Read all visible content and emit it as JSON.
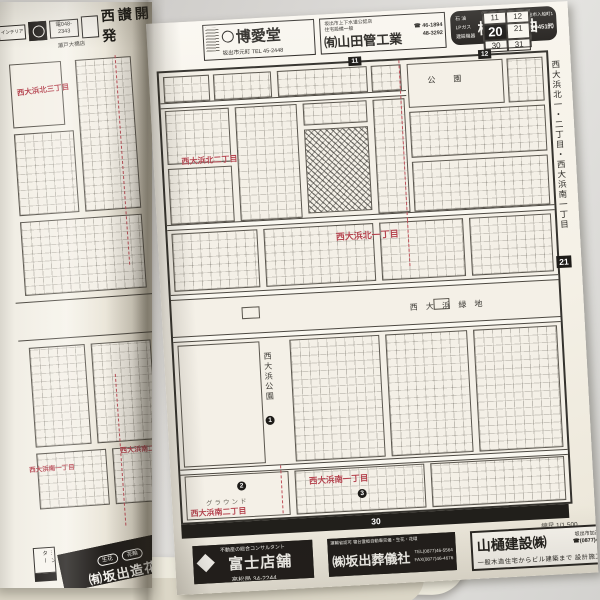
{
  "left_page": {
    "top_ads": {
      "interior_label": "インテリア",
      "phone_box": "電048-2343",
      "large_ad": "西讃開発",
      "shop_label": "瀬戸大橋店"
    },
    "red_labels": [
      "西大浜北三丁目",
      "西大浜南一丁目",
      "西大浜南二丁目"
    ],
    "bottom_ads": {
      "partial_label": "…ンター",
      "zoka_badge1": "生花",
      "zoka_badge2": "花輪",
      "zoka_name": "㈲坂出造花"
    }
  },
  "right_page": {
    "top_ads": {
      "hakuaido": {
        "name": "博愛堂",
        "phone": "坂出市元町 TEL 45-2448"
      },
      "yamada": {
        "line1": "坂出市上下水道公認店",
        "line2": "住宅設備一般",
        "name": "㈲山田管工業",
        "phone1": "☎ 46-1894",
        "phone2": "48-3292"
      },
      "yokoi": {
        "left1": "石 油",
        "left2": "LPガス",
        "left3": "建設機器",
        "name": "横井石油",
        "addr": "坂出市入船町1",
        "phone": "☎(0877)46-0451㈹"
      }
    },
    "page_grid": {
      "cells": [
        "11",
        "12",
        "20",
        "21",
        "30",
        "31"
      ]
    },
    "top_edge_markers": [
      "11",
      "12"
    ],
    "margin_title": "西大浜北一・二丁目・西大浜南一丁目",
    "edge_marker": "21",
    "bottom_edge_marker": "30",
    "map": {
      "red_labels": [
        "西大浜北二丁目",
        "西大浜北一丁目",
        "西大浜南一丁目",
        "西大浜南二丁目"
      ],
      "black_labels": {
        "park_top": "公　園",
        "greenbelt": "西 大 浜 緑 地",
        "park_west": "西大浜公園",
        "ground": "グラウンド"
      },
      "circles": [
        "1",
        "2",
        "3"
      ],
      "scale": "縮尺 1/1,500"
    },
    "bottom_ads": {
      "fuji": {
        "tagline": "不動産の総合コンサルタント",
        "name": "富士店舗",
        "phone": "高松局 34-2244"
      },
      "sougisha": {
        "top": "運輸省認可 寝台霊柩自動車完備・生花・花環",
        "name": "㈱坂出葬儀社",
        "tel": "TEL(0877)46-5564",
        "fax": "FAX(0877)46-4676"
      },
      "yamahi": {
        "name": "山樋建設㈱",
        "addr": "坂出市加茂町47番",
        "phone": "☎(0877)48-6115",
        "services": "一般木造住宅からビル建築まで 設計施工"
      }
    }
  }
}
